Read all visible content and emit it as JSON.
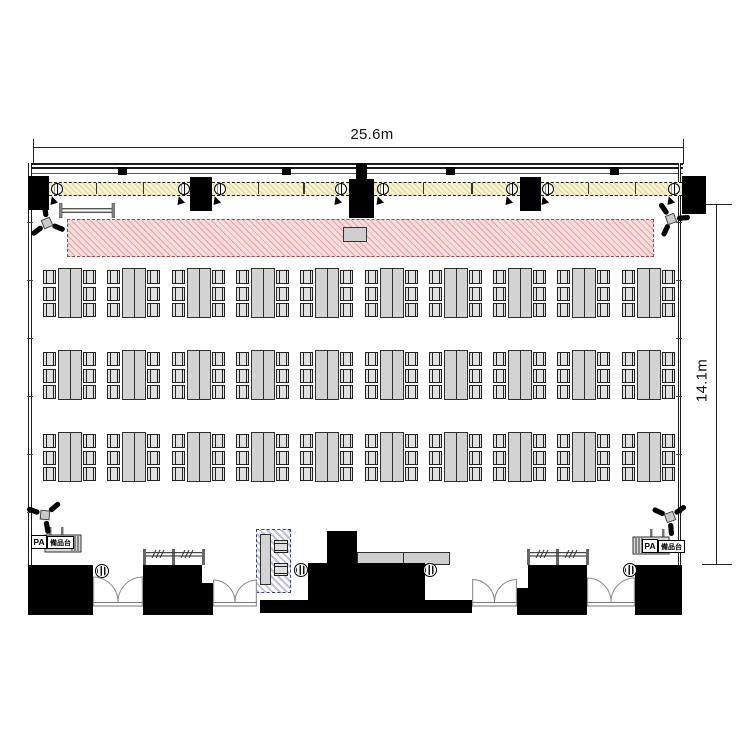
{
  "plan": {
    "type": "event-hall floor plan, classroom/banquet seating",
    "room": {
      "width_label": "25.6m",
      "depth_label": "14.1m"
    },
    "labels": {
      "pa": "PA",
      "equipment_stand": "備品台"
    },
    "seating": {
      "rows": 3,
      "groups_per_row": 10,
      "tables_per_group": 2,
      "chairs_per_side": 3,
      "total_chairs": 180
    },
    "features": {
      "stage": "hatched stage strip along front wall",
      "lectern": "small lectern on stage center",
      "light_battens": 4,
      "wall_speaker_boxes": 5,
      "spotlights": 8,
      "corner_speakers": 4,
      "double_doors": 4,
      "coat_racks": 2,
      "columns": 4,
      "operator_zone": "blue hatched desk with 2 chairs",
      "head_tables": 2,
      "pa_stations": 2
    },
    "colors": {
      "stage_fill": "#f8dcdc",
      "stage_hatch": "#cc6a6a",
      "light_strip_fill": "#f7f2cd",
      "operator_hatch": "#6870be",
      "table_fill": "#d3d3d3",
      "block_fill": "#000000"
    }
  }
}
